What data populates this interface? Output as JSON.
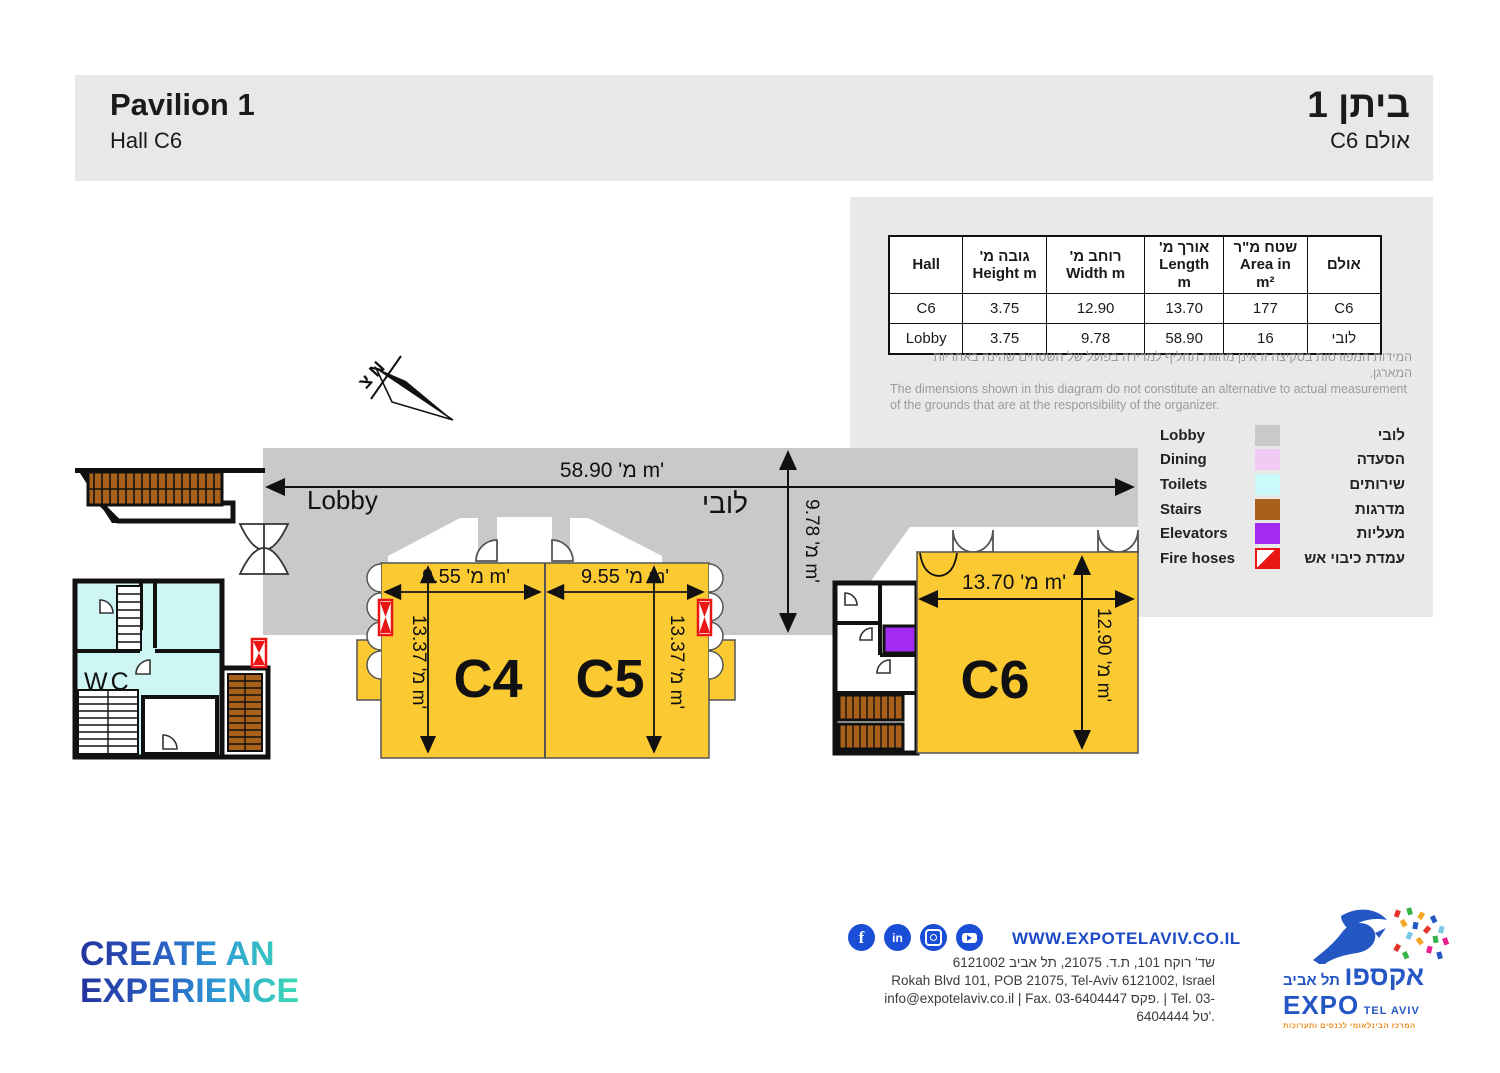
{
  "header": {
    "title_en": "Pavilion 1",
    "subtitle_en": "Hall C6",
    "title_he": "ביתן 1",
    "subtitle_he": "אולם C6"
  },
  "table": {
    "columns": [
      {
        "he": "",
        "en": "Hall"
      },
      {
        "he": "גובה מ'",
        "en": "Height m"
      },
      {
        "he": "רוחב מ'",
        "en": "Width m"
      },
      {
        "he": "אורך מ'",
        "en": "Length m"
      },
      {
        "he": "שטח מ\"ר",
        "en": "Area in m²"
      },
      {
        "he": "אולם",
        "en": ""
      }
    ],
    "rows": [
      [
        "C6",
        "3.75",
        "12.90",
        "13.70",
        "177",
        "C6"
      ],
      [
        "Lobby",
        "3.75",
        "9.78",
        "58.90",
        "16",
        "לובי"
      ]
    ]
  },
  "disclaimer": {
    "he": "המידות המפורטות בסקיצה זו אינן מהוות תחליף למדידה בפועל של השטחים שהינה באחריות המארגן.",
    "en": "The dimensions shown in this diagram do not constitute an alternative to actual measurement of the grounds that are at the responsibility of the organizer."
  },
  "legend": {
    "items": [
      {
        "en": "Lobby",
        "he": "לובי",
        "color": "#c9c9c9"
      },
      {
        "en": "Dining",
        "he": "הסעדה",
        "color": "#f2cbf5"
      },
      {
        "en": "Toilets",
        "he": "שירותים",
        "color": "#ccfafa"
      },
      {
        "en": "Stairs",
        "he": "מדרגות",
        "color": "#a9601a"
      },
      {
        "en": "Elevators",
        "he": "מעליות",
        "color": "#a32af0"
      },
      {
        "en": "Fire hoses",
        "he": "עמדת כיבוי אש",
        "color": "#ea1515"
      }
    ]
  },
  "plan": {
    "north_label": "צ N",
    "lobby_label_en": "Lobby",
    "lobby_label_he": "לובי",
    "wc_label": "WC",
    "halls": {
      "c4": "C4",
      "c5": "C5",
      "c6": "C6"
    },
    "dims": {
      "lobby_w": "מ' 58.90 m'",
      "lobby_h": "מ' 9.78 m'",
      "c4_w": "מ' 9.55 m'",
      "c5_w": "מ' 9.55 m'",
      "c4_h": "מ' 13.37 m'",
      "c5_h": "מ' 13.37 m'",
      "c6_w": "מ' 13.70 m'",
      "c6_h": "מ' 12.90 m'"
    }
  },
  "footer": {
    "slogan_line1": "CREATE AN",
    "slogan_line2": "EXPERIENCE",
    "social": [
      "facebook",
      "linkedin",
      "instagram",
      "youtube"
    ],
    "social_labels": {
      "facebook": "f",
      "linkedin": "in"
    },
    "website": "WWW.EXPOTELAVIV.CO.IL",
    "address_he": "שד' רוקח 101, ת.ד. 21075, תל אביב 6121002",
    "address_en": "Rokah Blvd 101, POB 21075, Tel-Aviv 6121002, Israel",
    "contact": "info@expotelaviv.co.il | Fax. 03-6404447 פקס. | Tel. 03-6404444 טל'.",
    "logo": {
      "he_big": "אקספו",
      "he_small": "תל אביב",
      "en_big": "EXPO",
      "en_small": "TEL AVIV",
      "tagline": "המרכז הבינלאומי לכנסים ותערוכות"
    }
  }
}
